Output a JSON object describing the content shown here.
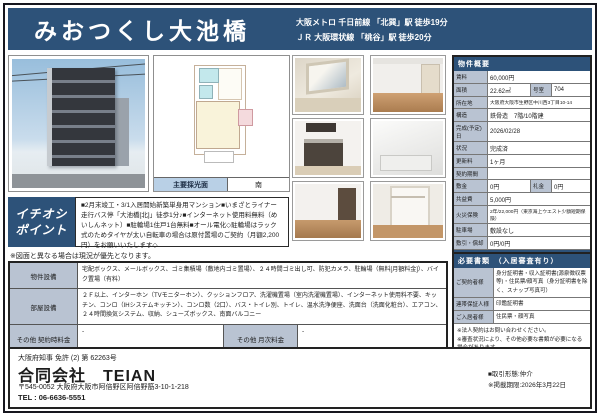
{
  "colors": {
    "accent": "#2d5279",
    "label_bg": "#b9c3d2",
    "lightblue_bar": "#b9d0e6"
  },
  "header": {
    "title": "みおつくし大池橋",
    "access_line1": "大阪メトロ 千日前線 「北巽」駅 徒歩19分",
    "access_line2": "ＪＲ 大阪環状線 「桃谷」駅 徒歩20分"
  },
  "floorplan": {
    "light_label": "主要採光面",
    "light_value": "南"
  },
  "ichioshi": {
    "label_line1": "イチオシ",
    "label_line2": "ポイント",
    "text": "■2月末竣工・3/1入居開始新築単身用マンション■いまざとライナー走行バス停「大池橋[北]」徒歩1分♪■インターネット使用料無料（めいしんネット）■駐輪場1住戸1台無料■オール電化◇駐輪場はラック式のためタイヤが太い自転車の場合は原付置場のご契約（月額2,200円）をお願いいたします◇"
  },
  "plan_note": "※図面と異なる場合は現況が優先となります。",
  "overview": {
    "header": "物件概要",
    "rent_label": "賃料",
    "rent": "60,000円",
    "area_label": "面積",
    "area": "22.62㎡",
    "room_label": "号室",
    "room": "704",
    "address_label": "所在地",
    "address": "大阪府大阪市生野区中川西3丁目10-14",
    "structure_label": "構造",
    "structure": "鉄骨造　7階/10階建",
    "completion_label": "完成(予定)日",
    "completion": "2026/02/28",
    "status_label": "状況",
    "status": "完成済",
    "renewal_label": "更新料",
    "renewal": "1ヶ月",
    "term_label": "契約期間",
    "term": "",
    "deposit_label": "敷金",
    "deposit": "0円",
    "keymoney_label": "礼金",
    "keymoney": "0円",
    "common_label": "共益費",
    "common": "5,000円",
    "fire_label": "火災保険",
    "fire": "2年/22,000円（東京海上ウエスト少額短期保険）",
    "parking_label": "駐車場",
    "parking": "敷設なし",
    "shikibiki_label": "敷引・償却",
    "shikibiki": "0円/0円"
  },
  "guarantee": {
    "header": "家賃保証会社／その他費用",
    "text": "●クレディセゾン:初回50%、引落時毎月1%●退去時クリーニング費用 35,000円（税別）●駐輪場1住戸1台無料●原付置場月額2,200円●更新料 新賃料の1.0ヵ月分●短期解約違約金：1年未満の解約で賃料1ヵ月●法人契約の場合礼金1ヶ月変更"
  },
  "documents": {
    "header": "必要書類　（入居審査有り）",
    "rows": [
      {
        "label": "ご契約者様",
        "value": "身分証明書・収入証明書(源泉徴収票等)・住民票/顔写真（身分証明書を除く、スナップ写真可）"
      },
      {
        "label": "連帯保証人様",
        "value": "印鑑証明書"
      },
      {
        "label": "ご入居者様",
        "value": "住民票・顔写真"
      }
    ],
    "note1": "※法人契約はお問い合わせください。",
    "note2": "※審査状況により、その他必要な書類が必要になる場合があります。"
  },
  "equipment": {
    "property_label": "物件設備",
    "property_value": "宅配ボックス、メールボックス、ゴミ集積場（敷地内ゴミ置場）、２４時間ゴミ出し可、防犯カメラ、駐輪場（無料[月額料金]）、バイク置場（有料）",
    "room_label": "部屋設備",
    "room_value": "２Ｆ以上、インターホン（TVモニターホン）、クッションフロア、洗濯機置場（室内洗濯機置場）、インターネット使用料不要、キッチン、コンロ（IHシステムキッチン）、コンロ数（2口）、バス・トイレ別、トイレ、温水洗浄便座、洗面台（洗面化粧台）、エアコン、２４時間換気システム、収納、シューズボックス、南面バルコニー",
    "other_contract_label": "その他 契約時料金",
    "other_contract_value": "-",
    "other_monthly_label": "その他 月次料金",
    "other_monthly_value": "-"
  },
  "company": {
    "license": "大阪府知事 免許 (2) 第 62263号",
    "name": "合同会社　TEIAN",
    "address": "〒545-0052 大阪府大阪市阿倍野区阿倍野筋3-10-1-218",
    "tel": "TEL : 06-6636-5551",
    "deal_type": "■取引形態:仲介",
    "deadline": "※掲載期限:2026年3月22日"
  }
}
